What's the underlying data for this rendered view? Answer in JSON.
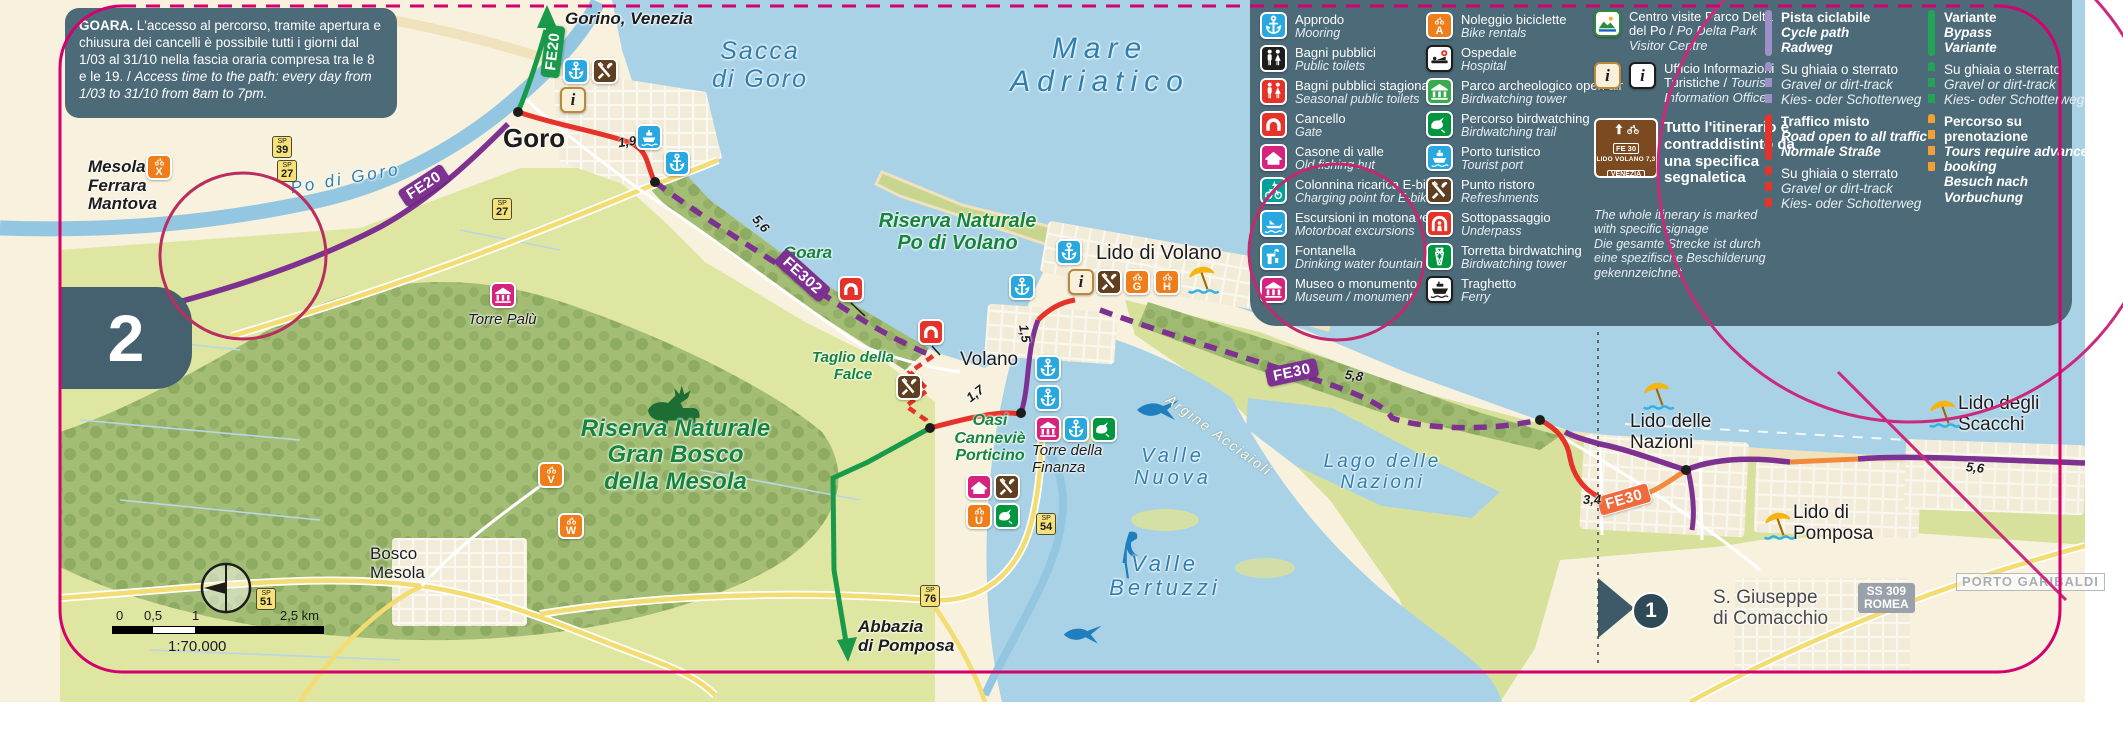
{
  "page": {
    "number": "2",
    "marker": "1"
  },
  "info_box": {
    "title": "GOARA.",
    "text_it": " L'accesso al percorso, tramite apertura e chiusura dei cancelli è possibile tutti i giorni dal 1/03 al 31/10 nella fascia oraria compresa tra le 8 e le 19. / ",
    "text_en": "Access time to the path: every day from 1/03 to 31/10 from 8am to 7pm."
  },
  "legend": {
    "info_letter": "i",
    "col1": [
      {
        "it": "Approdo",
        "en": "Mooring",
        "icon": "anchor",
        "color": "#29a8e0"
      },
      {
        "it": "Bagni pubblici",
        "en": "Public toilets",
        "icon": "toilets",
        "color": "#1d1d1b"
      },
      {
        "it": "Bagni pubblici stagionali",
        "en": "Seasonal public toilets",
        "icon": "toilets",
        "color": "#e5332a"
      },
      {
        "it": "Cancello",
        "en": "Gate",
        "icon": "gate",
        "color": "#e5332a"
      },
      {
        "it": "Casone di valle",
        "en": "Old fishing hut",
        "icon": "hut",
        "color": "#d6247e"
      },
      {
        "it": "Colonnina ricarica E-bike",
        "en": "Charging point for E-bike",
        "icon": "ebike",
        "color": "#00a19a"
      },
      {
        "it": "Escursioni in motonave",
        "en": "Motorboat excursions",
        "icon": "motorboat",
        "color": "#29a8e0"
      },
      {
        "it": "Fontanella",
        "en": "Drinking water fountain",
        "icon": "fountain",
        "color": "#29a8e0"
      },
      {
        "it": "Museo o monumento",
        "en": "Museum / monument",
        "icon": "museum",
        "color": "#d6247e"
      }
    ],
    "col2": [
      {
        "it": "Noleggio biciclette",
        "en": "Bike rentals",
        "icon": "bike",
        "color": "#ef7d1a",
        "letter": "A"
      },
      {
        "it": "Ospedale",
        "en": "Hospital",
        "icon": "hospital",
        "color": "#ffffff"
      },
      {
        "it": "Parco archeologico open air",
        "en": "Birdwatching tower",
        "icon": "museum",
        "color": "#3aaa4f"
      },
      {
        "it": "Percorso birdwatching",
        "en": "Birdwatching trail",
        "icon": "bird",
        "color": "#00963f"
      },
      {
        "it": "Porto turistico",
        "en": "Tourist port",
        "icon": "ship",
        "color": "#29a8e0"
      },
      {
        "it": "Punto ristoro",
        "en": "Refreshments",
        "icon": "cutlery",
        "color": "#5f3f20"
      },
      {
        "it": "Sottopassaggio",
        "en": "Underpass",
        "icon": "underpass",
        "color": "#e5332a"
      },
      {
        "it": "Torretta birdwatching",
        "en": "Birdwatching tower",
        "icon": "tower",
        "color": "#00963f"
      },
      {
        "it": "Traghetto",
        "en": "Ferry",
        "icon": "ferry",
        "color": "#ffffff"
      }
    ],
    "visitor_centre": {
      "it": "Centro visite Parco Delta del Po / ",
      "en": "Po Delta Park Visitor Centre"
    },
    "info_office": {
      "it": "Ufficio Informazioni Turistiche / ",
      "en": "Tourist Information Office"
    },
    "sign": {
      "fe": "FE 30",
      "dest": "LIDO VOLANO",
      "dist": "7,3",
      "dest2": "VENEZIA"
    },
    "signage_note": {
      "it": "Tutto l'itinerario è contraddistinto da una specifica segnaletica",
      "en": "The whole itinerary is marked with specific signage",
      "de": "Die gesamte Strecke ist durch eine spezifische Beschilderung gekennzeichnet"
    },
    "routes": [
      {
        "it": "Pista ciclabile",
        "en": "Cycle path",
        "de": "Radweg",
        "color": "#9d8fc8",
        "style": "solid"
      },
      {
        "it": "Su ghiaia o sterrato",
        "en": "Gravel or dirt-track",
        "de": "Kies- oder Schotterweg",
        "color": "#9d8fc8",
        "style": "dashed"
      },
      {
        "it": "Traffico misto",
        "en": "Road open to all traffic",
        "de": "Normale Straße",
        "color": "#e5332a",
        "style": "solid"
      },
      {
        "it": "Su ghiaia o sterrato",
        "en": "Gravel or dirt-track",
        "de": "Kies- oder Schotterweg",
        "color": "#e5332a",
        "style": "dashed"
      },
      {
        "it": "Variante",
        "en": "Bypass",
        "de": "Variante",
        "color": "#23a357",
        "style": "solid"
      },
      {
        "it": "Su ghiaia o sterrato",
        "en": "Gravel or dirt-track",
        "de": "Kies- oder Schotterweg",
        "color": "#23a357",
        "style": "dashed"
      },
      {
        "it": "Percorso su prenotazione",
        "en": "Tours require advance booking",
        "de": "Besuch nach Vorbuchung",
        "color": "#f2a033",
        "style": "dashed"
      }
    ]
  },
  "map": {
    "labels": {
      "gorino": "Gorino, Venezia",
      "goro": "Goro",
      "mesola": "Mesola\nFerrara\nMantova",
      "po_di_goro": "Po di Goro",
      "sacca": "Sacca\ndi Goro",
      "mare": "Mare\nAdriatico",
      "riserva_volano": "Riserva Naturale\nPo di Volano",
      "lido_volano": "Lido di Volano",
      "goara": "Goara",
      "torre_palu": "Torre Palù",
      "taglio": "Taglio della\nFalce",
      "volano": "Volano",
      "oasi": "Oasi\nCanneviè\nPorticino",
      "torre_finanza": "Torre della\nFinanza",
      "valle_nuova": "Valle\nNuova",
      "valle_bertuzzi": "Valle\nBertuzzi",
      "lago_nazioni": "Lago delle\nNazioni",
      "argine": "Argine Acciaioli",
      "bosco_mesola": "Bosco\nMesola",
      "abbazia": "Abbazia\ndi Pomposa",
      "riserva_mesola": "Riserva Naturale\nGran Bosco\ndella Mesola",
      "lido_nazioni": "Lido delle\nNazioni",
      "lido_scacchi": "Lido degli\nScacchi",
      "lido_pomposa": "Lido di\nPomposa",
      "s_giuseppe": "S. Giuseppe\ndi Comacchio",
      "porto_garibaldi": "PORTO GARIBALDI"
    },
    "badges": {
      "fe20": "FE20",
      "fe302": "FE302",
      "fe30": "FE30"
    },
    "distances": {
      "goro": "1,9",
      "goara": "5,6",
      "volano_a": "1,7",
      "volano_b": "1,5",
      "fe30": "5,8",
      "nazioni": "3,4",
      "scacchi": "5,6"
    },
    "roads": {
      "sp": "SP",
      "n27": "27",
      "n39": "39",
      "n51": "51",
      "n54": "54",
      "n76": "76",
      "ss309": "SS 309\nROMEA"
    },
    "letters": {
      "g": "G",
      "h": "H",
      "u": "U",
      "v": "V",
      "w": "W",
      "x": "X"
    },
    "scale": {
      "t0": "0",
      "t05": "0,5",
      "t1": "1",
      "t25": "2,5 km",
      "ratio": "1:70.000"
    }
  }
}
